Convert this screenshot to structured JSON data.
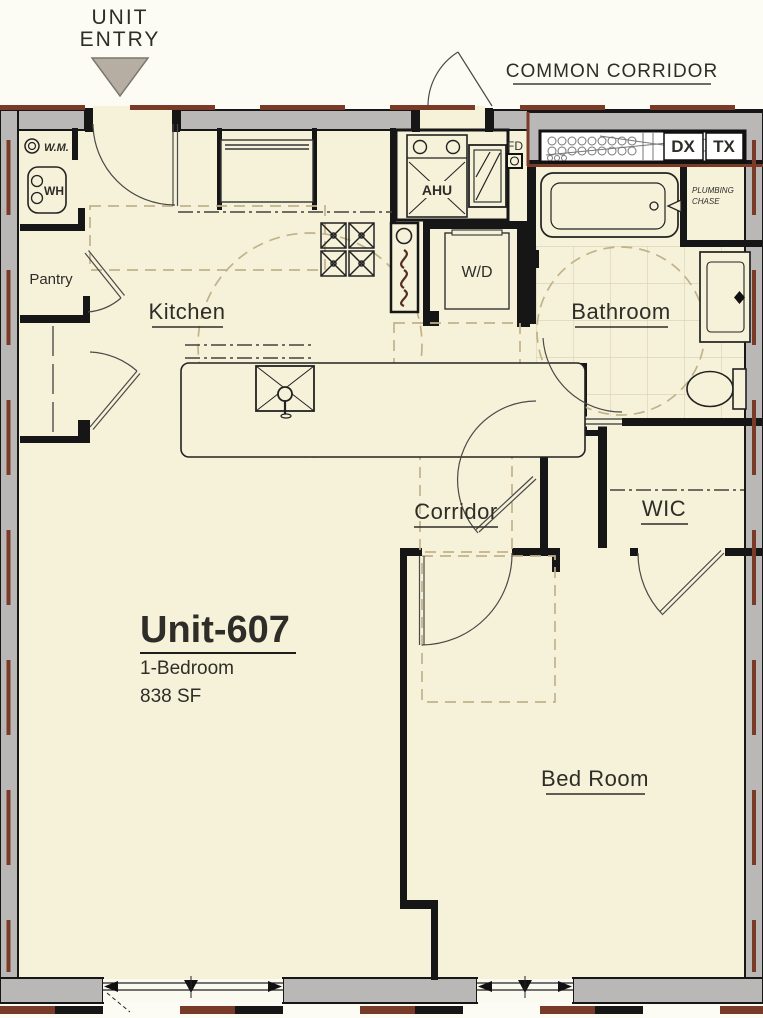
{
  "header": {
    "unit_entry_line1": "UNIT",
    "unit_entry_line2": "ENTRY",
    "common_corridor": "COMMON CORRIDOR"
  },
  "unit": {
    "name": "Unit-607",
    "type": "1-Bedroom",
    "area": "838 SF"
  },
  "rooms": {
    "kitchen": "Kitchen",
    "pantry": "Pantry",
    "bathroom": "Bathroom",
    "corridor": "Corridor",
    "wic": "WIC",
    "bedroom": "Bed Room"
  },
  "equipment": {
    "washing_machine": "W.M.",
    "water_heater": "WH",
    "air_handler": "AHU",
    "fire_damper": "FD",
    "washer_dryer": "W/D",
    "plumbing_chase_line1": "PLUMBING",
    "plumbing_chase_line2": "CHASE",
    "dx": "DX",
    "tx": "TX"
  },
  "colors": {
    "floor_cream": "#f6f2da",
    "wall_gray": "#b9b8b6",
    "wall_black": "#161616",
    "fire_rating_brown": "#7a3a28",
    "clearance_tan": "#c2b28a",
    "tile_line": "#d6d0b5"
  }
}
